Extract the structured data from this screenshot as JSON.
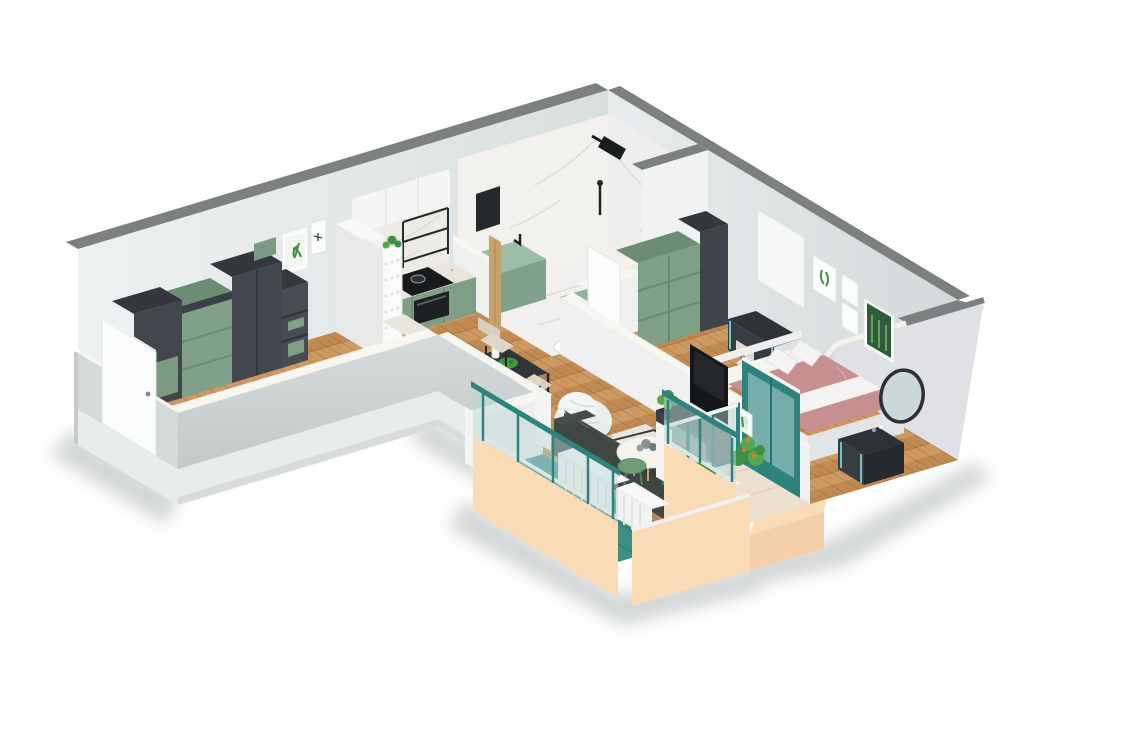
{
  "scene": {
    "type": "isometric-floorplan-3d-render",
    "description": "Cutaway 3D isometric render of a one-bedroom apartment on a white background",
    "background": "#ffffff",
    "visible_text": []
  },
  "palette": {
    "background": "#ffffff",
    "wall_top_gray": "#7d8080",
    "wall_face_light": "#eff1f1",
    "wall_face_shaded": "#dde2e3",
    "wall_exterior_gray": "#cbd1d1",
    "wall_cut_top_cream": "#f8f6f1",
    "slab_white": "#e9ecec",
    "wood_floor": "#cd9a62",
    "wood_floor_dark": "#c18a52",
    "marble_white": "#f1f0ee",
    "cabinet_green": "#7e9e86",
    "cabinet_green_dark": "#6c8d74",
    "vanity_mint": "#8fb39a",
    "furniture_dark": "#3a4045",
    "furniture_darkest": "#26292b",
    "bedding_pink": "#c69090",
    "accent_wall_pink": "#e7cfdf",
    "balcony_peach": "#f9dcb6",
    "railing_teal": "#2f837e",
    "glass_teal": "#bcd8d5",
    "balcony_floor_teal": "#418d87",
    "door_white": "#fbfcfc",
    "plant_green": "#3f8f44",
    "plant_green_light": "#58a74e",
    "flower_orange": "#e5762a",
    "rug_cream": "#eae5da",
    "tv_black": "#14171a",
    "shadow_gray": "#9aa0a0"
  },
  "rooms": [
    {
      "name": "entry-hallway",
      "floor": "herringbone-wood",
      "furniture": [
        "dark-wardrobe-units",
        "green-drawer-units",
        "open-shelf-with-green-bins",
        "framed-botanical-print",
        "framed-dragonfly-print",
        "entry-door"
      ]
    },
    {
      "name": "kitchen",
      "floor": "herringbone-wood",
      "furniture": [
        "green-lower-cabinets",
        "terrazzo-countertop",
        "black-cooktop",
        "built-in-oven",
        "white-upper-cabinets",
        "black-open-shelf",
        "white-fridge",
        "white-pegboard-partition",
        "green-side-cabinet"
      ]
    },
    {
      "name": "bathroom",
      "floor": "marble",
      "furniture": [
        "bathtub",
        "mint-vanity",
        "black-shower-set",
        "black-wall-mirror",
        "toilet",
        "mint-bench-with-towels",
        "wood-door-jamb",
        "white-door"
      ]
    },
    {
      "name": "bedroom",
      "floor": "herringbone-wood",
      "furniture": [
        "double-bed-pink-bedding",
        "white-bed-frame",
        "pillows",
        "desk-with-teal-legs",
        "chair",
        "green-closet",
        "dark-closet",
        "gallery-wall-four-frames",
        "vanity-dresser",
        "round-mirror",
        "window"
      ]
    },
    {
      "name": "living-dining",
      "floor": "herringbone-wood",
      "furniture": [
        "black-dining-table",
        "three-beige-chairs",
        "fruit-bowl",
        "white-bean-bag",
        "patterned-rug",
        "dark-sofa",
        "round-white-coffee-table",
        "green-side-table",
        "tv-wall-unit-green-drawers",
        "tv",
        "leaning-art-frames",
        "plant-box"
      ]
    },
    {
      "name": "bedroom-balcony",
      "floor": "beige-tile",
      "furniture": [
        "teal-glass-door",
        "teal-glass-railing",
        "potted-plants-orange-flowers",
        "pink-accent-wall",
        "peach-parapet"
      ]
    },
    {
      "name": "living-balcony",
      "floor": "teal-deck",
      "furniture": [
        "white-radiator-units",
        "teal-glass-railing",
        "peach-parapet",
        "white-pillars"
      ]
    }
  ]
}
